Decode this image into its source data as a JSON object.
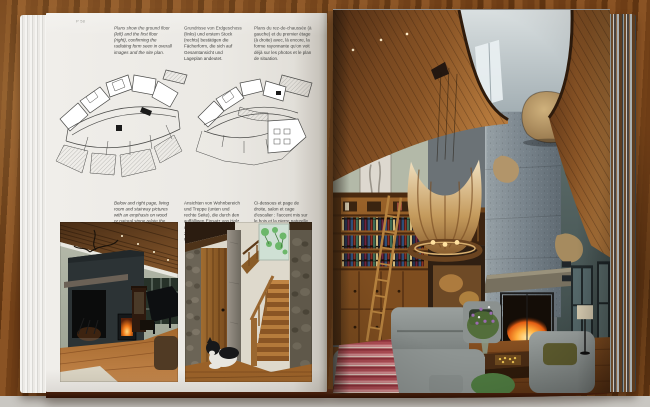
{
  "meta": {
    "page_number": "P 58"
  },
  "captions": {
    "plans": {
      "en": "Plans show the ground floor (left) and the first floor (right), confirming the radiating form seen in overall images and the site plan.",
      "de": "Grundrisse von Erdgeschoss (links) und erstem Stock (rechts) bestätigen die Fächerform, die sich auf Gesamtansicht und Lageplan andeutet.",
      "fr": "Plans du rez-de-chaussée (à gauche) et du premier étage (à droite) avec, là encore, la forme rayonnante qu'on voit déjà sur les photos et le plan de situation."
    },
    "interiors": {
      "en": "Below and right page, living room and stairway pictures with an emphasis on wood or natural stone relate the residence to its forested environment.",
      "de": "Ansichten von Wohnbereich und Treppe (unten und rechte Seite), die durch den auffälligen Einsatz von Holz und Naturstein den Bezug zwischen Haus und Waldlandschaft schaffen.",
      "fr": "Ci-dessous et page de droite, salon et cage d'escalier : l'accent mis sur le bois et la pierre naturelle créent un lien entre la maison et la forêt environnante."
    }
  },
  "colors": {
    "table_wood": "#7a4418",
    "page_paper": "#edebe7",
    "ceiling_wood": "#8a5526",
    "chimney_concrete": "#7d8890",
    "sofa_gray": "#8e9492",
    "fire_orange": "#f07818",
    "throw_red": "#b4505a",
    "bookshelf_wood": "#9a632a"
  }
}
